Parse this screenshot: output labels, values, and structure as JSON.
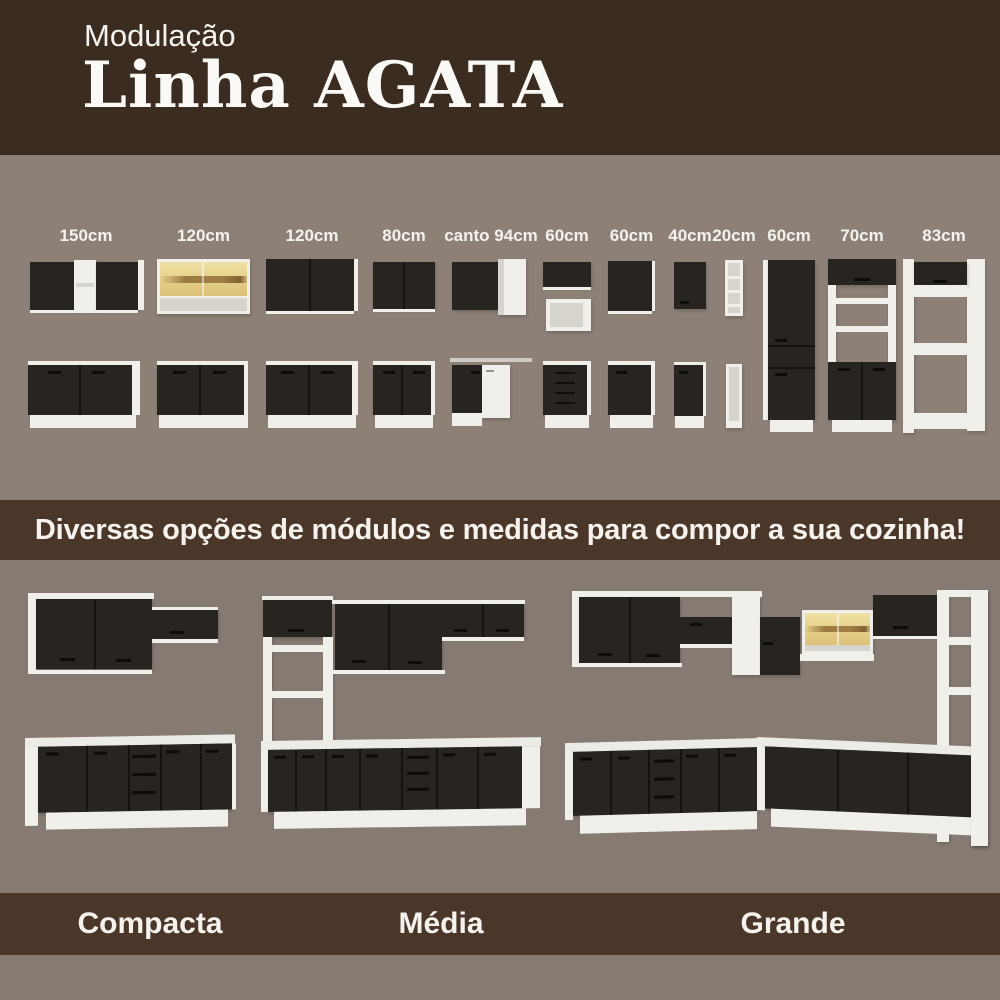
{
  "header": {
    "kicker": "Modulação",
    "title": "Linha AGATA"
  },
  "modules_section": {
    "items": [
      {
        "label": "150cm"
      },
      {
        "label": "120cm"
      },
      {
        "label": "120cm"
      },
      {
        "label": "80cm"
      },
      {
        "label": "canto 94cm"
      },
      {
        "label": "60cm"
      },
      {
        "label": "60cm"
      },
      {
        "label": "40cm"
      },
      {
        "label": "20cm"
      },
      {
        "label": "60cm"
      },
      {
        "label": "70cm"
      },
      {
        "label": "83cm"
      }
    ]
  },
  "banner": {
    "text": "Diversas opções de módulos e medidas para compor a sua cozinha!"
  },
  "kitchens_section": {
    "items": [
      {
        "label": "Compacta"
      },
      {
        "label": "Média"
      },
      {
        "label": "Grande"
      }
    ]
  },
  "colors": {
    "header_brown": "#3a2c21",
    "band_brown": "#4a3729",
    "top_background": "#8c8077",
    "bottom_background": "#867b73",
    "cabinet_black": "#282521",
    "cabinet_white": "#f1efea",
    "glass_amber": "#e7d28c",
    "wood_streak": "#8f6a35",
    "text_white": "#f6f3ef"
  }
}
